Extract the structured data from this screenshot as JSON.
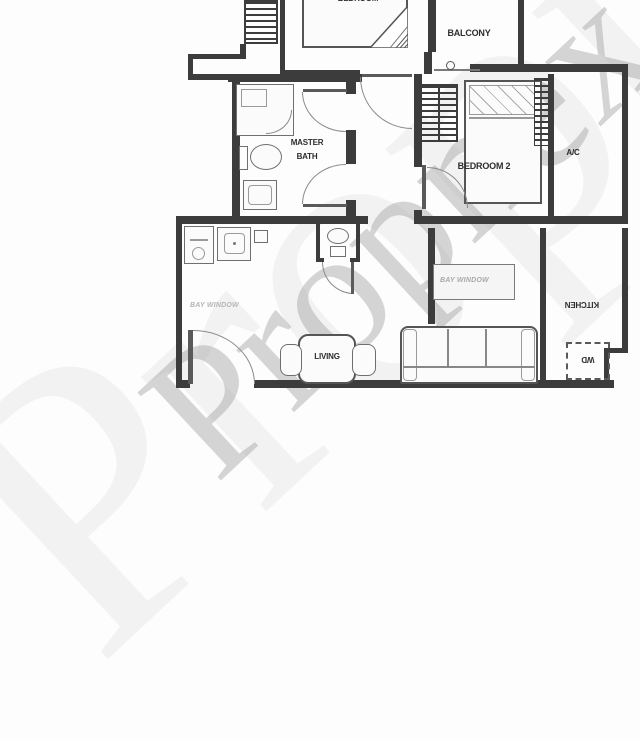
{
  "watermark": {
    "text": "Propnex",
    "color": "#9e9e9e"
  },
  "labels": {
    "bedroom": "BEDROOM",
    "balcony": "BALCONY",
    "master_bath_line1": "MASTER",
    "master_bath_line2": "BATH",
    "bedroom2": "BEDROOM 2",
    "ac": "A/C",
    "living": "LIVING",
    "kitchen": "KITCHEN",
    "wd": "WD",
    "bay_left": "BAY WINDOW",
    "bay_right": "BAY WINDOW"
  },
  "colors": {
    "wall": "#3c3c3c",
    "furniture_line": "#6f6f6f",
    "label_text": "#2d2d2d",
    "faint_text": "#b5b5b5",
    "watermark": "#9e9e9e",
    "background": "#fdfdfd"
  }
}
